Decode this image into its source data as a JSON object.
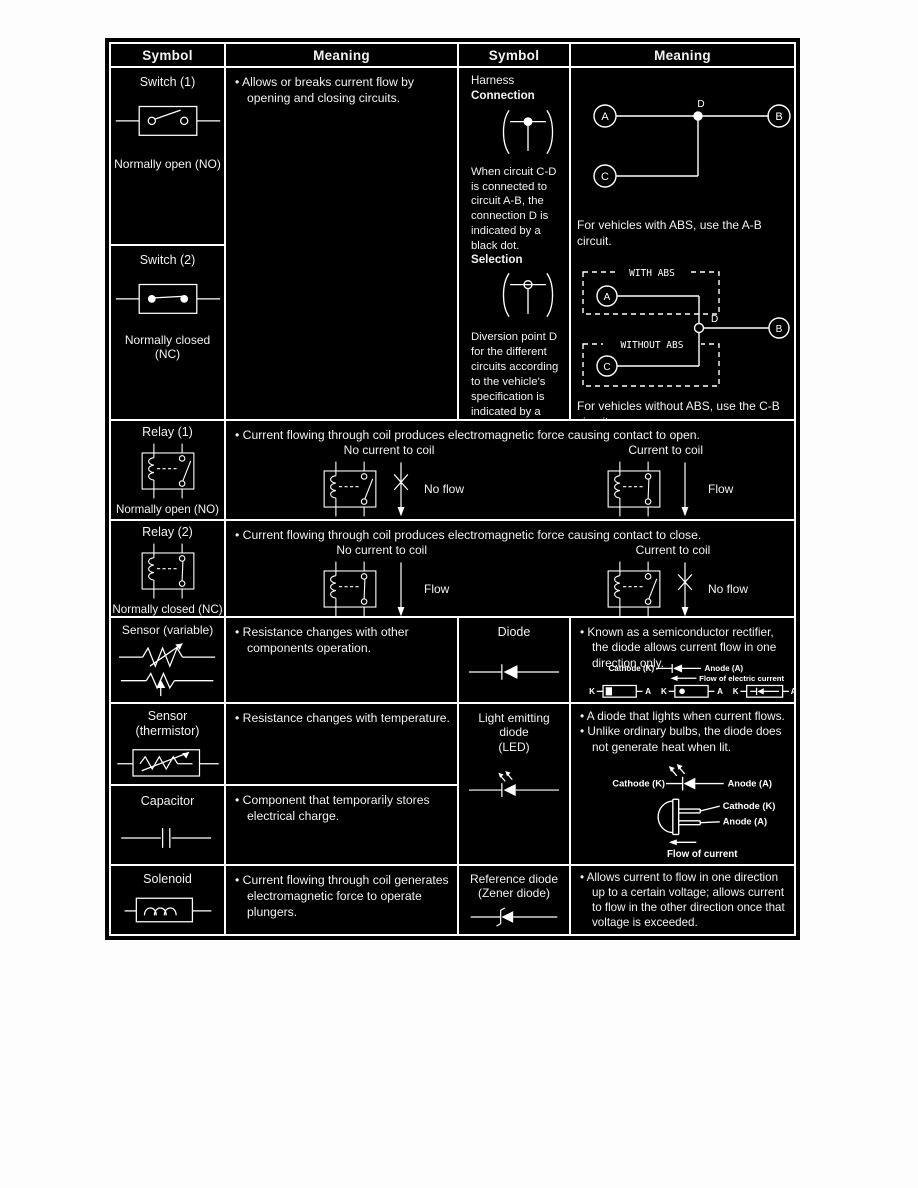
{
  "header": {
    "symbol_left": "Symbol",
    "meaning_left": "Meaning",
    "symbol_right": "Symbol",
    "meaning_right": "Meaning"
  },
  "switch1": {
    "title": "Switch (1)",
    "caption": "Normally open (NO)"
  },
  "switch2": {
    "title": "Switch (2)",
    "caption": "Normally closed (NC)"
  },
  "switch_meaning": "• Allows or breaks current flow by opening and closing circuits.",
  "harness": {
    "title1": "Harness",
    "title2": "Connection",
    "desc": "When circuit C-D is connected to circuit A-B, the connection D is indicated by a black dot.",
    "selection_title": "Selection",
    "selection_desc": "Diversion point D for the different circuits according to the vehicle's specification is indicated by a white dot."
  },
  "abs_diagram": {
    "a": "A",
    "b": "B",
    "c": "C",
    "d": "D",
    "with_caption": "For vehicles with ABS, use the A-B circuit.",
    "with_box": "WITH ABS",
    "without_box": "WITHOUT ABS",
    "without_caption": "For vehicles without ABS, use the C-B circuit."
  },
  "relay1": {
    "title": "Relay (1)",
    "caption": "Normally open (NO)",
    "meaning": "• Current flowing through coil produces electromagnetic force causing contact to open.",
    "left_label": "No current to coil",
    "left_flow": "No flow",
    "right_label": "Current to coil",
    "right_flow": "Flow"
  },
  "relay2": {
    "title": "Relay (2)",
    "caption": "Normally closed (NC)",
    "meaning": "• Current flowing through coil produces electromagnetic force causing contact to close.",
    "left_label": "No current to coil",
    "left_flow": "Flow",
    "right_label": "Current to coil",
    "right_flow": "No flow"
  },
  "sensor_variable": {
    "title": "Sensor (variable)",
    "meaning": "• Resistance changes with other components operation."
  },
  "diode": {
    "title": "Diode",
    "meaning": "• Known as a semiconductor rectifier, the diode allows current flow in one direction only.",
    "cathode": "Cathode (K)",
    "anode": "Anode (A)",
    "flow": "Flow of electric current",
    "k": "K",
    "a": "A"
  },
  "thermistor": {
    "title1": "Sensor",
    "title2": "(thermistor)",
    "meaning": "• Resistance changes with temperature."
  },
  "led": {
    "title1": "Light emitting",
    "title2": "diode",
    "title3": "(LED)",
    "meaning1": "• A diode that lights when current flows.",
    "meaning2": "• Unlike ordinary bulbs, the diode does not generate heat when lit.",
    "cathode": "Cathode (K)",
    "anode": "Anode (A)",
    "cathode2": "Cathode (K)",
    "anode2": "Anode (A)",
    "flow": "Flow of current"
  },
  "capacitor": {
    "title": "Capacitor",
    "meaning": "• Component that temporarily stores electrical charge."
  },
  "solenoid": {
    "title": "Solenoid",
    "meaning": "• Current flowing through coil generates electromagnetic force to operate plungers."
  },
  "zener": {
    "title1": "Reference diode",
    "title2": "(Zener diode)",
    "meaning": "• Allows current to flow in one direction up to a certain voltage; allows current to flow in the other direction once that voltage is exceeded."
  }
}
